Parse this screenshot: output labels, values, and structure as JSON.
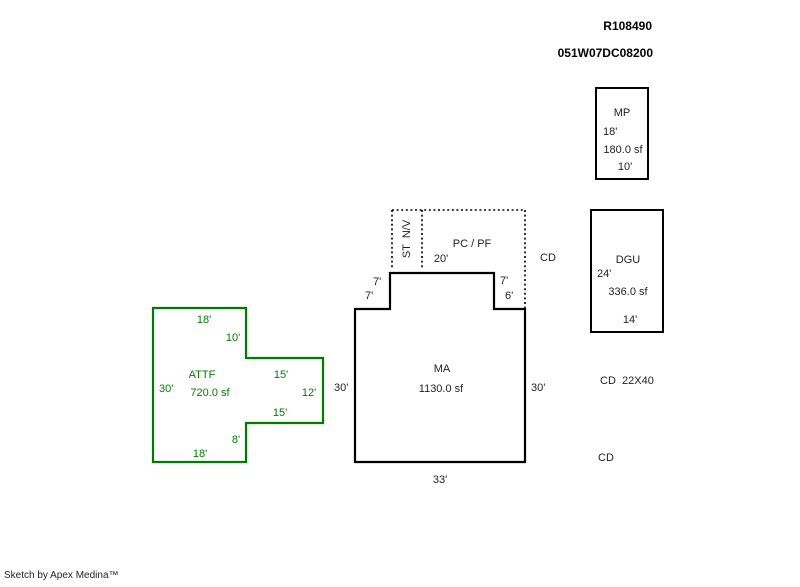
{
  "header": {
    "record_id": "R108490",
    "parcel_id": "051W07DC08200"
  },
  "shapes": {
    "mp": {
      "label": "MP",
      "height_dim": "18'",
      "area": "180.0 sf",
      "width_dim": "10'"
    },
    "dgu": {
      "label": "DGU",
      "height_dim": "24'",
      "area": "336.0 sf",
      "width_dim": "14'"
    },
    "pcpf": {
      "label": "PC / PF",
      "width_dim": "20'",
      "strip_label": "ST  N/V"
    },
    "ma": {
      "label": "MA",
      "area": "1130.0 sf",
      "dims": {
        "left_step_height": "7'",
        "left_step_width": "7'",
        "right_step_height": "7'",
        "right_step_width": "6'",
        "left_side": "30'",
        "right_side": "30'",
        "bottom_width": "33'"
      }
    },
    "attf": {
      "label": "ATTF",
      "area": "720.0 sf",
      "dims": {
        "top_width": "18'",
        "upper_right": "10'",
        "arm_top": "15'",
        "arm_right": "12'",
        "arm_bottom": "15'",
        "lower_right": "8'",
        "bottom_width": "18'",
        "left_side": "30'"
      }
    }
  },
  "annotations": {
    "cd_upper": "CD",
    "cd_dimensions": "CD  22X40",
    "cd_lower": "CD"
  },
  "footer": {
    "credit": "Sketch by Apex Medina™"
  },
  "colors": {
    "outline": "#000000",
    "accent_green": "#007d00",
    "text": "#1f1f1f"
  }
}
